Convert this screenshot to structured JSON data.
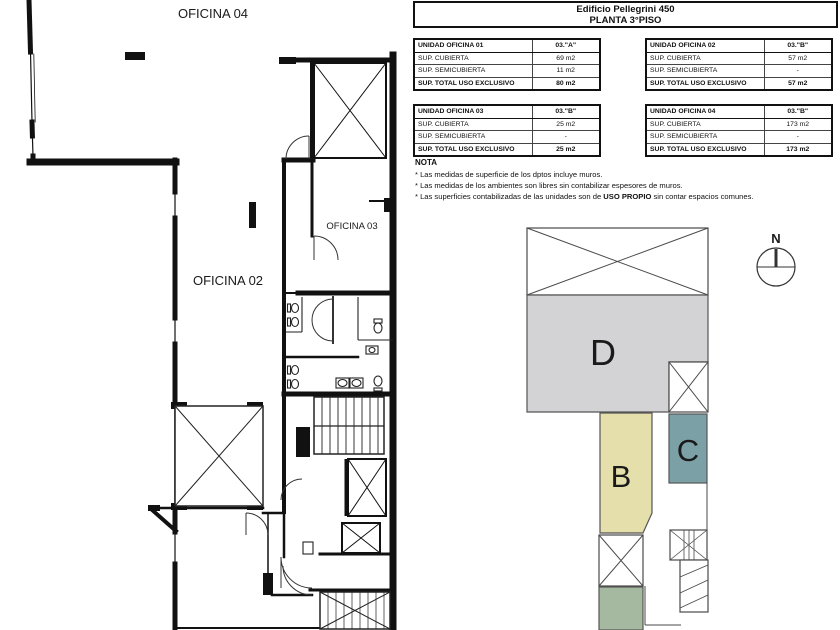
{
  "header": {
    "title": "Edificio Pellegrini 450",
    "subtitle": "PLANTA 3°PISO"
  },
  "tables": [
    {
      "name": "UNIDAD OFICINA 01",
      "unit": "03.\"A\"",
      "rows": [
        [
          "SUP. CUBIERTA",
          "69 m2"
        ],
        [
          "SUP. SEMICUBIERTA",
          "11 m2"
        ]
      ],
      "total_label": "SUP. TOTAL USO EXCLUSIVO",
      "total": "80 m2"
    },
    {
      "name": "UNIDAD OFICINA 02",
      "unit": "03.\"B\"",
      "rows": [
        [
          "SUP. CUBIERTA",
          "57 m2"
        ],
        [
          "SUP. SEMICUBIERTA",
          "-"
        ]
      ],
      "total_label": "SUP. TOTAL USO EXCLUSIVO",
      "total": "57 m2"
    },
    {
      "name": "UNIDAD OFICINA 03",
      "unit": "03.\"B\"",
      "rows": [
        [
          "SUP. CUBIERTA",
          "25 m2"
        ],
        [
          "SUP. SEMICUBIERTA",
          "-"
        ]
      ],
      "total_label": "SUP. TOTAL USO EXCLUSIVO",
      "total": "25 m2"
    },
    {
      "name": "UNIDAD OFICINA 04",
      "unit": "03.\"B\"",
      "rows": [
        [
          "SUP. CUBIERTA",
          "173 m2"
        ],
        [
          "SUP. SEMICUBIERTA",
          "-"
        ]
      ],
      "total_label": "SUP. TOTAL USO EXCLUSIVO",
      "total": "173 m2"
    }
  ],
  "nota": {
    "title": "NOTA",
    "items": [
      {
        "pre": "* Las medidas de superficie de los dptos incluye muros.",
        "bold": "",
        "post": ""
      },
      {
        "pre": "* Las medidas de los ambientes son libres sin contabilizar espesores de muros.",
        "bold": "",
        "post": ""
      },
      {
        "pre": "* Las superficies contabilizadas de las unidades son de ",
        "bold": "USO PROPIO",
        "post": " sin contar espacios comunes."
      }
    ]
  },
  "floor_plan": {
    "labels": {
      "oficina04": "OFICINA 04",
      "oficina02": "OFICINA 02",
      "oficina03": "OFICINA 03"
    }
  },
  "key_plan": {
    "unit_d": "D",
    "unit_b": "B",
    "unit_c": "C",
    "north": "N",
    "colors": {
      "unit_d": "#d3d3d5",
      "unit_b": "#e5dfab",
      "unit_c": "#7ba1a7",
      "unit_green": "#a5b9a0"
    }
  }
}
